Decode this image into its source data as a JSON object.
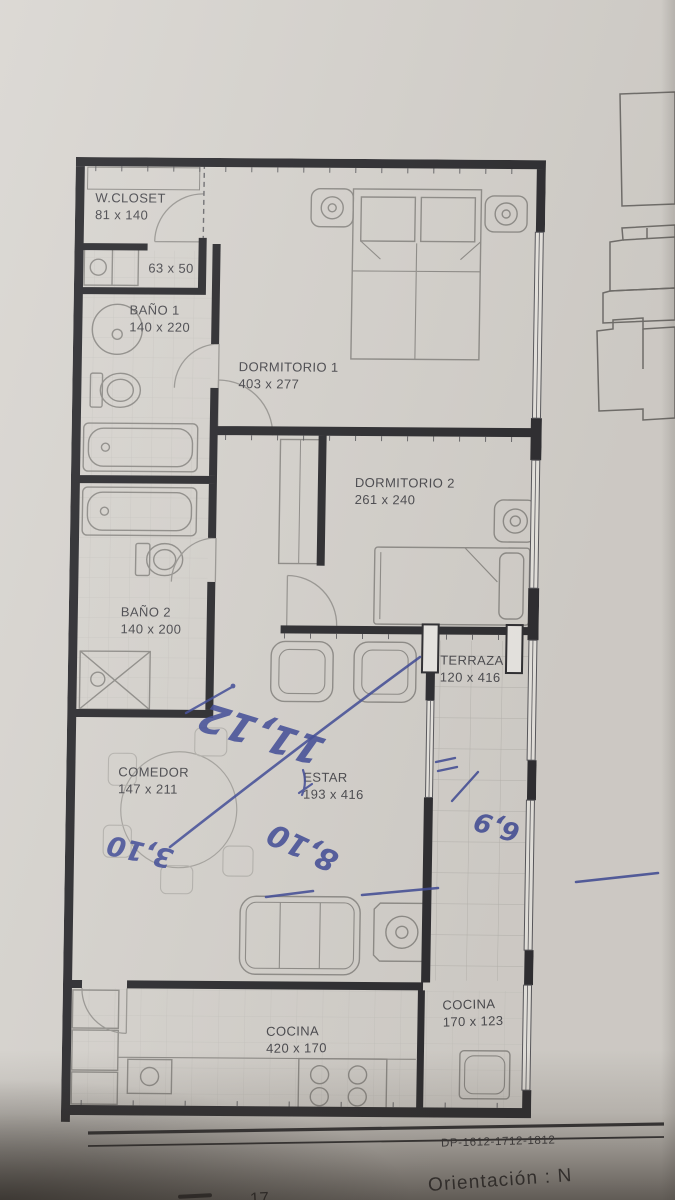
{
  "plan": {
    "rooms": {
      "wcloset": {
        "label": "W.CLOSET",
        "dims": "81 x 140"
      },
      "cab": {
        "dims": "63 x 50"
      },
      "bano1": {
        "label": "BAÑO 1",
        "dims": "140 x 220"
      },
      "dorm1": {
        "label": "DORMITORIO 1",
        "dims": "403 x 277"
      },
      "dorm2": {
        "label": "DORMITORIO 2",
        "dims": "261 x 240"
      },
      "bano2": {
        "label": "BAÑO 2",
        "dims": "140 x 200"
      },
      "terraza": {
        "label": "TERRAZA",
        "dims": "120 x 416"
      },
      "comedor": {
        "label": "COMEDOR",
        "dims": "147 x 211"
      },
      "estar": {
        "label": "ESTAR",
        "dims": "193 x 416"
      },
      "cocina_main": {
        "label": "COCINA",
        "dims": "420 x 170"
      },
      "cocina_small": {
        "label": "COCINA",
        "dims": "170 x 123"
      }
    },
    "footer": {
      "code": "DP-1612-1712-1812",
      "orientation": "Orientación : N",
      "page_fragment": "17"
    },
    "annotations": {
      "ink_color": "#3e4a99",
      "a_top": "11,12",
      "a_left": "3,10",
      "a_mid": "8,10",
      "a_right": "6,9"
    },
    "colors": {
      "wall": "#28282c",
      "paper": "#d8d5d0",
      "fixture_line": "#8e8c88",
      "tile_line": "#c9c7c2"
    }
  }
}
